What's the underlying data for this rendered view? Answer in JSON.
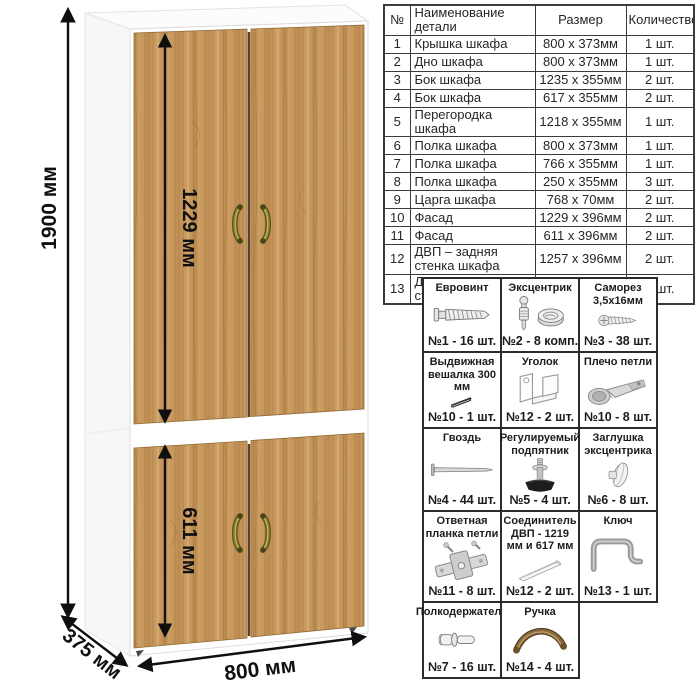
{
  "page_title": "Схема шкафа с размерами и фурнитурой",
  "dimensions": {
    "height": "1900 мм",
    "upper_door_height": "1229 мм",
    "lower_door_height": "611 мм",
    "width": "800 мм",
    "depth": "375 мм"
  },
  "parts_table": {
    "headers": {
      "num": "№",
      "name": "Наименование детали",
      "size": "Размер",
      "qty": "Количество"
    },
    "rows": [
      {
        "num": "1",
        "name": "Крышка шкафа",
        "size": "800 х 373мм",
        "qty": "1 шт."
      },
      {
        "num": "2",
        "name": "Дно шкафа",
        "size": "800 х 373мм",
        "qty": "1 шт."
      },
      {
        "num": "3",
        "name": "Бок шкафа",
        "size": "1235 х 355мм",
        "qty": "2 шт."
      },
      {
        "num": "4",
        "name": "Бок шкафа",
        "size": "617 х 355мм",
        "qty": "2 шт."
      },
      {
        "num": "5",
        "name": "Перегородка шкафа",
        "size": "1218 х 355мм",
        "qty": "1 шт."
      },
      {
        "num": "6",
        "name": "Полка шкафа",
        "size": "800 х 373мм",
        "qty": "1 шт."
      },
      {
        "num": "7",
        "name": "Полка шкафа",
        "size": "766 х 355мм",
        "qty": "1 шт."
      },
      {
        "num": "8",
        "name": "Полка шкафа",
        "size": "250 х 355мм",
        "qty": "3 шт."
      },
      {
        "num": "9",
        "name": "Царга шкафа",
        "size": "768 х 70мм",
        "qty": "2 шт."
      },
      {
        "num": "10",
        "name": "Фасад",
        "size": "1229 х 396мм",
        "qty": "2 шт."
      },
      {
        "num": "11",
        "name": "Фасад",
        "size": "611 х 396мм",
        "qty": "2 шт."
      },
      {
        "num": "12",
        "name": "ДВП – задняя стенка шкафа",
        "size": "1257 х 396мм",
        "qty": "2 шт."
      },
      {
        "num": "13",
        "name": "ДВП – задняя стенка шкафа",
        "size": "639 х 396мм",
        "qty": "2 шт."
      }
    ]
  },
  "hardware": {
    "rows": [
      [
        {
          "name": "Евровинт",
          "icon": "euro-screw",
          "qty": "№1 - 16 шт."
        },
        {
          "name": "Эксцентрик",
          "icon": "cam-lock",
          "qty": "№2 - 8 комп."
        },
        {
          "name": "Саморез 3,5х16мм",
          "icon": "self-tapping-screw",
          "qty": "№3 - 38 шт."
        }
      ],
      [
        {
          "name": "Выдвижная вешалка 300 мм",
          "icon": "pull-out-hanger",
          "qty": "№10 - 1 шт."
        },
        {
          "name": "Уголок",
          "icon": "corner-bracket",
          "qty": "№12 - 2 шт."
        },
        {
          "name": "Плечо петли",
          "icon": "hinge-arm",
          "qty": "№10 - 8 шт."
        }
      ],
      [
        {
          "name": "Гвоздь",
          "icon": "nail",
          "qty": "№4 - 44 шт."
        },
        {
          "name": "Регулируемый подпятник",
          "icon": "adjustable-foot",
          "qty": "№5 - 4 шт."
        },
        {
          "name": "Заглушка эксцентрика",
          "icon": "cam-cap",
          "qty": "№6 - 8 шт."
        }
      ],
      [
        {
          "name": "Ответная планка петли",
          "icon": "hinge-plate",
          "qty": "№11 - 8 шт."
        },
        {
          "name": "Соединитель ДВП - 1219 мм и 617 мм",
          "icon": "hdf-connector",
          "qty": "№12 - 2 шт."
        },
        {
          "name": "Ключ",
          "icon": "hex-key",
          "qty": "№13 - 1 шт."
        }
      ],
      [
        {
          "name": "Полкодержатель",
          "icon": "shelf-pin",
          "qty": "№7 - 16 шт."
        },
        {
          "name": "Ручка",
          "icon": "handle",
          "qty": "№14 - 4 шт."
        }
      ]
    ]
  },
  "colors": {
    "wood": "#c2915a",
    "wood_dark": "#96682f",
    "handle_bronze": "#6f6428",
    "carcass_white": "#ffffff",
    "table_border": "#3b3b3b",
    "arrow": "#101010"
  }
}
